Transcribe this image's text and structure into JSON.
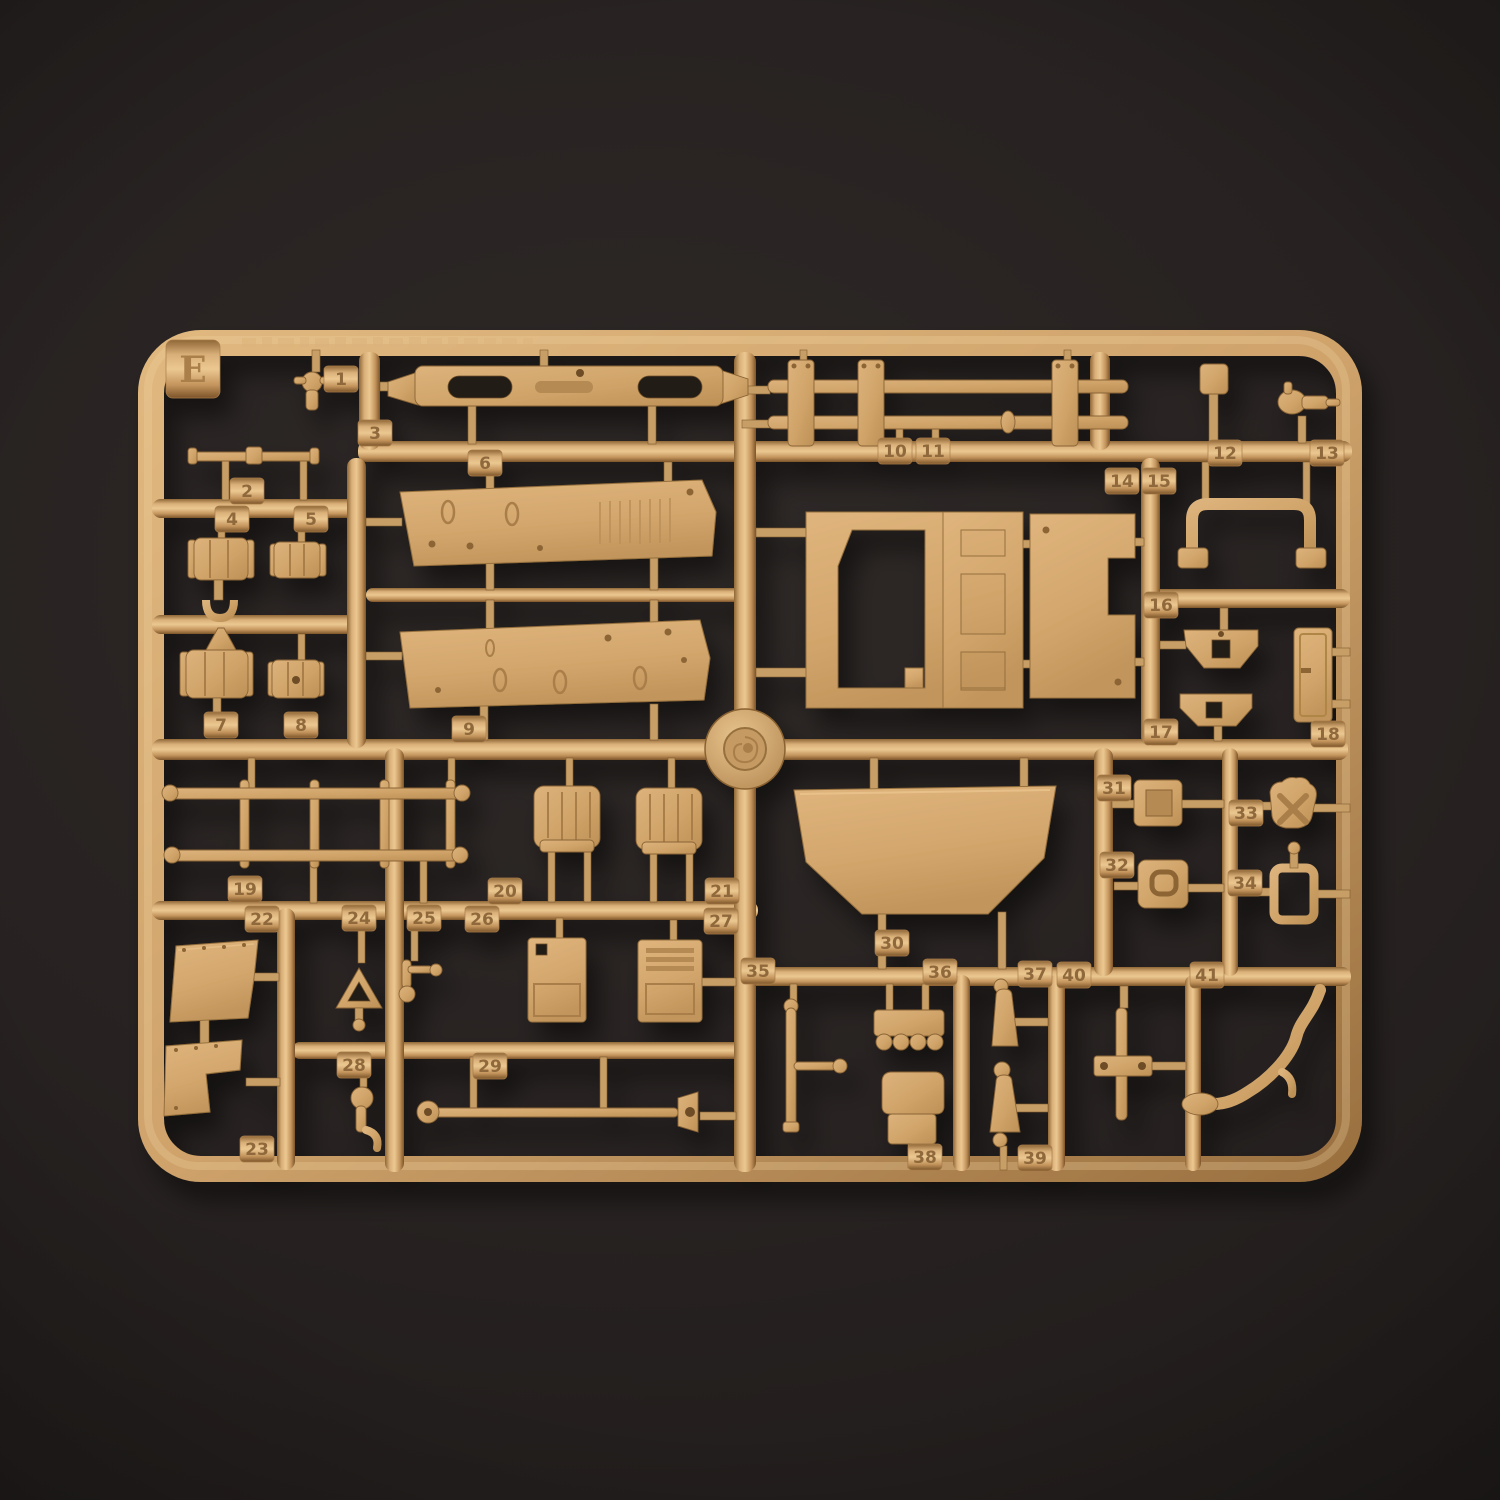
{
  "colors": {
    "background": "#211d1a",
    "sprue_base": "#cfa36b",
    "sprue_highlight": "#ecc891",
    "sprue_shadow": "#7c5429"
  },
  "sprue": {
    "letter": "E",
    "tabs": [
      {
        "n": "1",
        "x": 324,
        "y": 366
      },
      {
        "n": "2",
        "x": 230,
        "y": 478
      },
      {
        "n": "3",
        "x": 358,
        "y": 420
      },
      {
        "n": "4",
        "x": 215,
        "y": 506
      },
      {
        "n": "5",
        "x": 294,
        "y": 506
      },
      {
        "n": "6",
        "x": 468,
        "y": 450
      },
      {
        "n": "7",
        "x": 204,
        "y": 712
      },
      {
        "n": "8",
        "x": 284,
        "y": 712
      },
      {
        "n": "9",
        "x": 452,
        "y": 716
      },
      {
        "n": "10",
        "x": 878,
        "y": 438
      },
      {
        "n": "11",
        "x": 916,
        "y": 438
      },
      {
        "n": "12",
        "x": 1208,
        "y": 440
      },
      {
        "n": "13",
        "x": 1310,
        "y": 440
      },
      {
        "n": "14",
        "x": 1105,
        "y": 468
      },
      {
        "n": "15",
        "x": 1142,
        "y": 468
      },
      {
        "n": "16",
        "x": 1144,
        "y": 592
      },
      {
        "n": "17",
        "x": 1144,
        "y": 719
      },
      {
        "n": "18",
        "x": 1311,
        "y": 721
      },
      {
        "n": "19",
        "x": 228,
        "y": 876
      },
      {
        "n": "20",
        "x": 488,
        "y": 878
      },
      {
        "n": "21",
        "x": 705,
        "y": 878
      },
      {
        "n": "22",
        "x": 245,
        "y": 906
      },
      {
        "n": "23",
        "x": 240,
        "y": 1136
      },
      {
        "n": "24",
        "x": 342,
        "y": 905
      },
      {
        "n": "25",
        "x": 407,
        "y": 905
      },
      {
        "n": "26",
        "x": 465,
        "y": 906
      },
      {
        "n": "27",
        "x": 704,
        "y": 908
      },
      {
        "n": "28",
        "x": 337,
        "y": 1052
      },
      {
        "n": "29",
        "x": 473,
        "y": 1053
      },
      {
        "n": "30",
        "x": 875,
        "y": 930
      },
      {
        "n": "31",
        "x": 1097,
        "y": 775
      },
      {
        "n": "32",
        "x": 1100,
        "y": 852
      },
      {
        "n": "33",
        "x": 1229,
        "y": 800
      },
      {
        "n": "34",
        "x": 1228,
        "y": 870
      },
      {
        "n": "35",
        "x": 741,
        "y": 958
      },
      {
        "n": "36",
        "x": 923,
        "y": 959
      },
      {
        "n": "37",
        "x": 1018,
        "y": 961
      },
      {
        "n": "38",
        "x": 908,
        "y": 1144
      },
      {
        "n": "39",
        "x": 1018,
        "y": 1145
      },
      {
        "n": "40",
        "x": 1057,
        "y": 962
      },
      {
        "n": "41",
        "x": 1190,
        "y": 962
      }
    ]
  }
}
